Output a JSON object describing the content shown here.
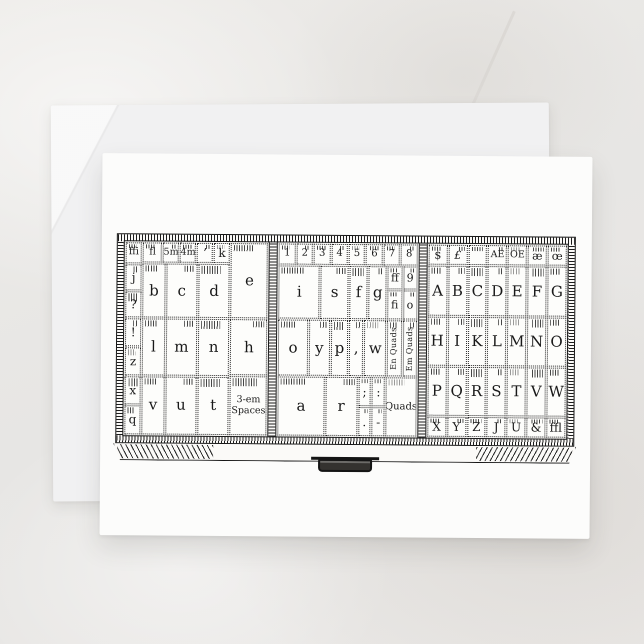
{
  "colors": {
    "background_marble": "#e9e8e6",
    "envelope": "#f1f1f2",
    "card": "#fcfcfb",
    "ink": "#191919"
  },
  "case": {
    "left": {
      "side_col": [
        "ffi",
        "j",
        "?",
        "!",
        "z",
        "x",
        "q"
      ],
      "top_row": [
        "fl",
        "5m",
        "4m",
        "’",
        "k"
      ],
      "row_b": [
        "b",
        "c",
        "d"
      ],
      "col4": [
        "e",
        "h"
      ],
      "row_c": [
        "l",
        "m",
        "n"
      ],
      "row_d": [
        "v",
        "u",
        "t"
      ],
      "spaces_line1": "3-em",
      "spaces_line2": "Spaces"
    },
    "middle": {
      "digits": [
        "1",
        "2",
        "3",
        "4",
        "5",
        "6",
        "7",
        "8"
      ],
      "row_b": [
        "i",
        "s",
        "f",
        "g"
      ],
      "mini": [
        "ff",
        "9",
        "fi",
        "o"
      ],
      "row_c": [
        "o",
        "y",
        "p",
        ",",
        "w"
      ],
      "quad_cols": [
        "En Quads",
        "Em Quads"
      ],
      "row_d": [
        "a",
        "r"
      ],
      "punct": [
        ";",
        ":",
        ".",
        "-"
      ],
      "quads_label": "Quads"
    },
    "right": {
      "top_row": [
        "$",
        "£",
        "",
        "AE",
        "OE",
        "æ",
        "œ"
      ],
      "row_a": [
        "A",
        "B",
        "C",
        "D",
        "E",
        "F",
        "G"
      ],
      "row_h": [
        "H",
        "I",
        "K",
        "L",
        "M",
        "N",
        "O"
      ],
      "row_p": [
        "P",
        "Q",
        "R",
        "S",
        "T",
        "V",
        "W"
      ],
      "bottom_row": [
        "X",
        "Y",
        "Z",
        "J",
        "U",
        "&",
        "ffl"
      ]
    }
  }
}
